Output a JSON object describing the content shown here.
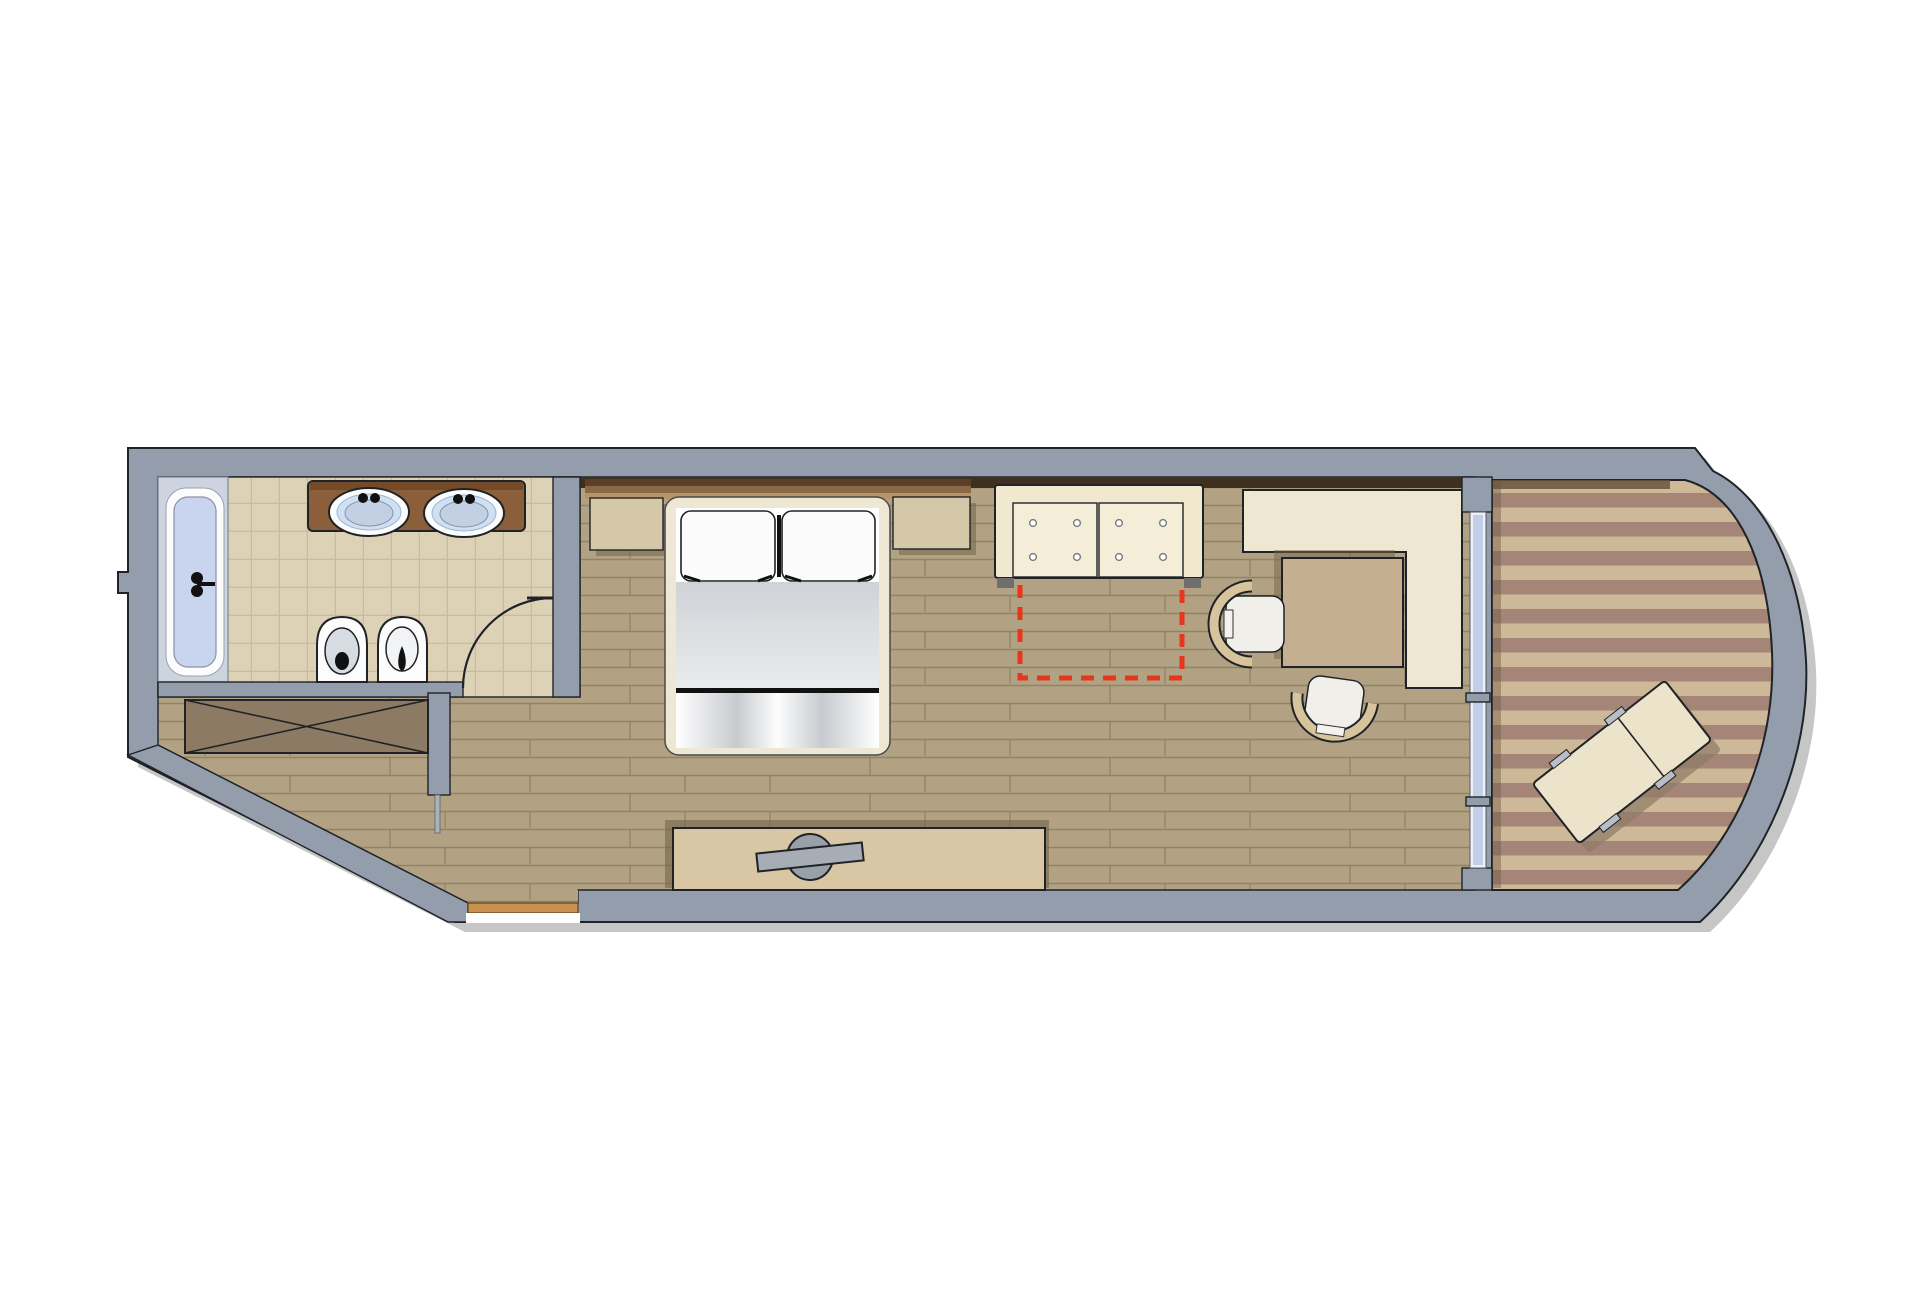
{
  "meta": {
    "title": "Hotel guest-room floor plan (top view)",
    "canvas": {
      "width": 1920,
      "height": 1306
    },
    "type": "architectural-floor-plan",
    "text_labels": []
  },
  "colors": {
    "wall": "#939dac",
    "wall_light": "#aab2bf",
    "shadow": "#c6c6c6",
    "wood": "#b2a283",
    "wood_line": "#8d7d5f",
    "tile": "#ded2b6",
    "tile_line": "#c9bc9e",
    "deck_dark": "#a58578",
    "deck_light": "#cdb897",
    "tub_deck": "#cdd4e0",
    "tub_water": "#c9d4ef",
    "fixture_white": "#fcfcfc",
    "fixture_gray": "#d7dbe2",
    "counter": "#8a5f3a",
    "counter_dark": "#6e4526",
    "sink_blue": "#cfe0f4",
    "sink_inner": "#c3cfe2",
    "closet": "#8d7a64",
    "sofa_cream": "#f0e9cf",
    "sofa_cushion": "#f4eed8",
    "nightstand_tan": "#d5c8a9",
    "desk_cream": "#eee8d3",
    "table_tan": "#c4af90",
    "chair_tan": "#d8c49c",
    "chair_seat": "#f1efe9",
    "dresser_tan": "#d9c6a5",
    "tv_gray": "#a6adb5",
    "tv_gray_dark": "#98a0a8",
    "bed_frame": "#eee7d4",
    "bed_white": "#ffffff",
    "window_glass": "#c3cee8",
    "window_frame": "#eef1f7",
    "threshold": "#c8914f",
    "red_dash": "#e8361c",
    "lounger_cream": "#ece3cb",
    "lounger_handle": "#b9bec6",
    "shelf_dark": "#5b4026",
    "shelf_mid": "#8a6747",
    "shelf_light": "#b89469",
    "sill_dark": "#3f2f1e",
    "balcony_shade": "#6b543f",
    "furn_shadow": "#756449"
  },
  "rooms": [
    {
      "name": "bathroom",
      "floor": "beige-tile"
    },
    {
      "name": "entry-hall",
      "floor": "wood-plank"
    },
    {
      "name": "wardrobe-niche",
      "floor": "wood-plank"
    },
    {
      "name": "bedroom-living-area",
      "floor": "wood-plank"
    },
    {
      "name": "balcony",
      "floor": "striped-decking"
    }
  ],
  "fixtures": [
    {
      "name": "bathtub",
      "room": "bathroom"
    },
    {
      "name": "double-sink-vanity",
      "room": "bathroom",
      "sinks": 2
    },
    {
      "name": "toilet",
      "room": "bathroom"
    },
    {
      "name": "bidet",
      "room": "bathroom"
    },
    {
      "name": "bathroom-door",
      "room": "bathroom",
      "state": "open-swing-arc"
    },
    {
      "name": "built-in-wardrobe",
      "room": "wardrobe-niche",
      "symbol": "crossed-rectangle"
    },
    {
      "name": "entrance-threshold",
      "room": "entry-hall"
    }
  ],
  "furniture": [
    {
      "name": "double-bed",
      "room": "bedroom-living-area",
      "pillows": 2
    },
    {
      "name": "nightstand-left",
      "room": "bedroom-living-area"
    },
    {
      "name": "nightstand-right",
      "room": "bedroom-living-area"
    },
    {
      "name": "headboard-shelf",
      "room": "bedroom-living-area"
    },
    {
      "name": "sofa",
      "room": "bedroom-living-area",
      "cushions": 2,
      "buttons_per_cushion": 4
    },
    {
      "name": "l-shaped-desk",
      "room": "bedroom-living-area"
    },
    {
      "name": "side-table",
      "room": "bedroom-living-area"
    },
    {
      "name": "chair-left",
      "room": "bedroom-living-area"
    },
    {
      "name": "chair-bottom",
      "room": "bedroom-living-area"
    },
    {
      "name": "tv-sideboard",
      "room": "bedroom-living-area"
    },
    {
      "name": "flat-tv",
      "room": "bedroom-living-area"
    },
    {
      "name": "sliding-window-door",
      "room": "balcony"
    },
    {
      "name": "sun-lounger",
      "room": "balcony",
      "rotation_deg": -38
    }
  ],
  "annotations": [
    {
      "name": "sofa-bed-extension-outline",
      "style": "dashed",
      "color": "#e8361c",
      "meaning": "fold-out area in front of sofa"
    }
  ]
}
